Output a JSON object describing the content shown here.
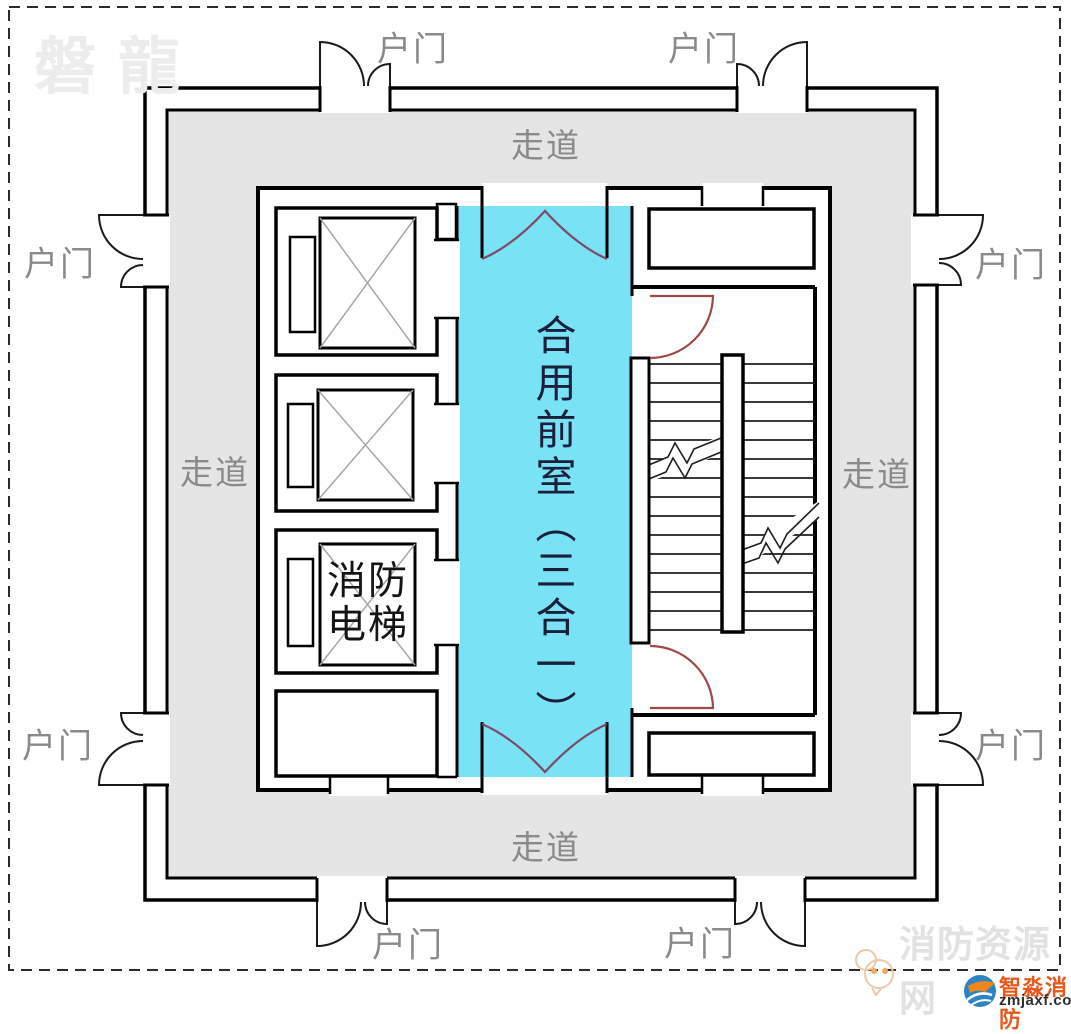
{
  "watermark_brand": "磐龍",
  "plan": {
    "corridor_label": "走道",
    "entry_door_label": "户门",
    "front_room_label": "合用前室（三合一）",
    "fire_elevator_line1": "消防",
    "fire_elevator_line2": "电梯"
  },
  "footer": {
    "site_name": "消防资源网",
    "brand_name": "智淼消防",
    "brand_domain": "zmjaxf.com"
  },
  "colors": {
    "front_room_fill": "#79E2F5",
    "corridor_fill": "#E5E5E5",
    "wall": "#000000",
    "stair_door_arc": "#9C4947",
    "front_room_door_arc": "#7E4A66",
    "label_gray": "#8A8A8A",
    "watermark_gray": "#ECECEC",
    "brand_orange": "#E8581C",
    "logo_blue": "#2B84C4"
  }
}
